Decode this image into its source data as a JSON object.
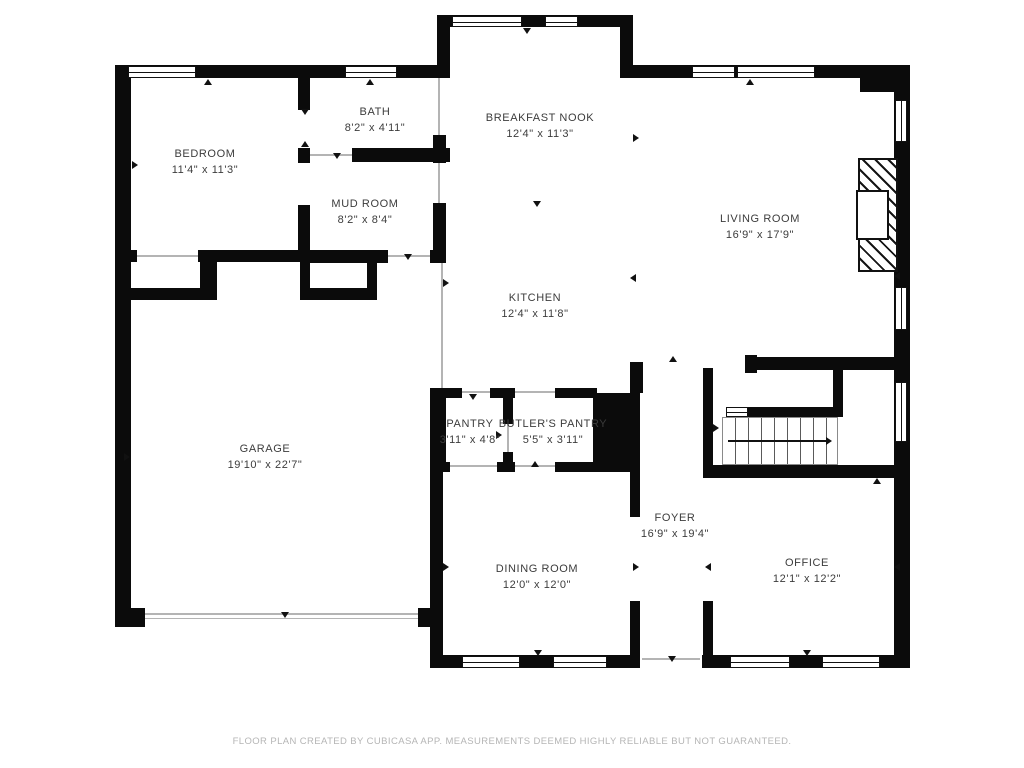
{
  "floorplan": {
    "rooms": [
      {
        "name": "BEDROOM",
        "dims": "11'4\" x 11'3\""
      },
      {
        "name": "BATH",
        "dims": "8'2\" x 4'11\""
      },
      {
        "name": "MUD ROOM",
        "dims": "8'2\" x 8'4\""
      },
      {
        "name": "BREAKFAST NOOK",
        "dims": "12'4\" x 11'3\""
      },
      {
        "name": "LIVING ROOM",
        "dims": "16'9\" x 17'9\""
      },
      {
        "name": "KITCHEN",
        "dims": "12'4\" x 11'8\""
      },
      {
        "name": "GARAGE",
        "dims": "19'10\" x 22'7\""
      },
      {
        "name": "PANTRY",
        "dims": "3'11\" x 4'8\""
      },
      {
        "name": "BUTLER'S PANTRY",
        "dims": "5'5\" x 3'11\""
      },
      {
        "name": "FOYER",
        "dims": "16'9\" x 19'4\""
      },
      {
        "name": "DINING ROOM",
        "dims": "12'0\" x 12'0\""
      },
      {
        "name": "OFFICE",
        "dims": "12'1\" x 12'2\""
      }
    ],
    "footer": "FLOOR PLAN CREATED BY CUBICASA APP. MEASUREMENTS DEEMED HIGHLY RELIABLE BUT NOT GUARANTEED.",
    "colors": {
      "wall": "#0b0b0b",
      "label": "#3c3c3c",
      "footer": "#b5b5b5",
      "background": "#ffffff"
    }
  }
}
